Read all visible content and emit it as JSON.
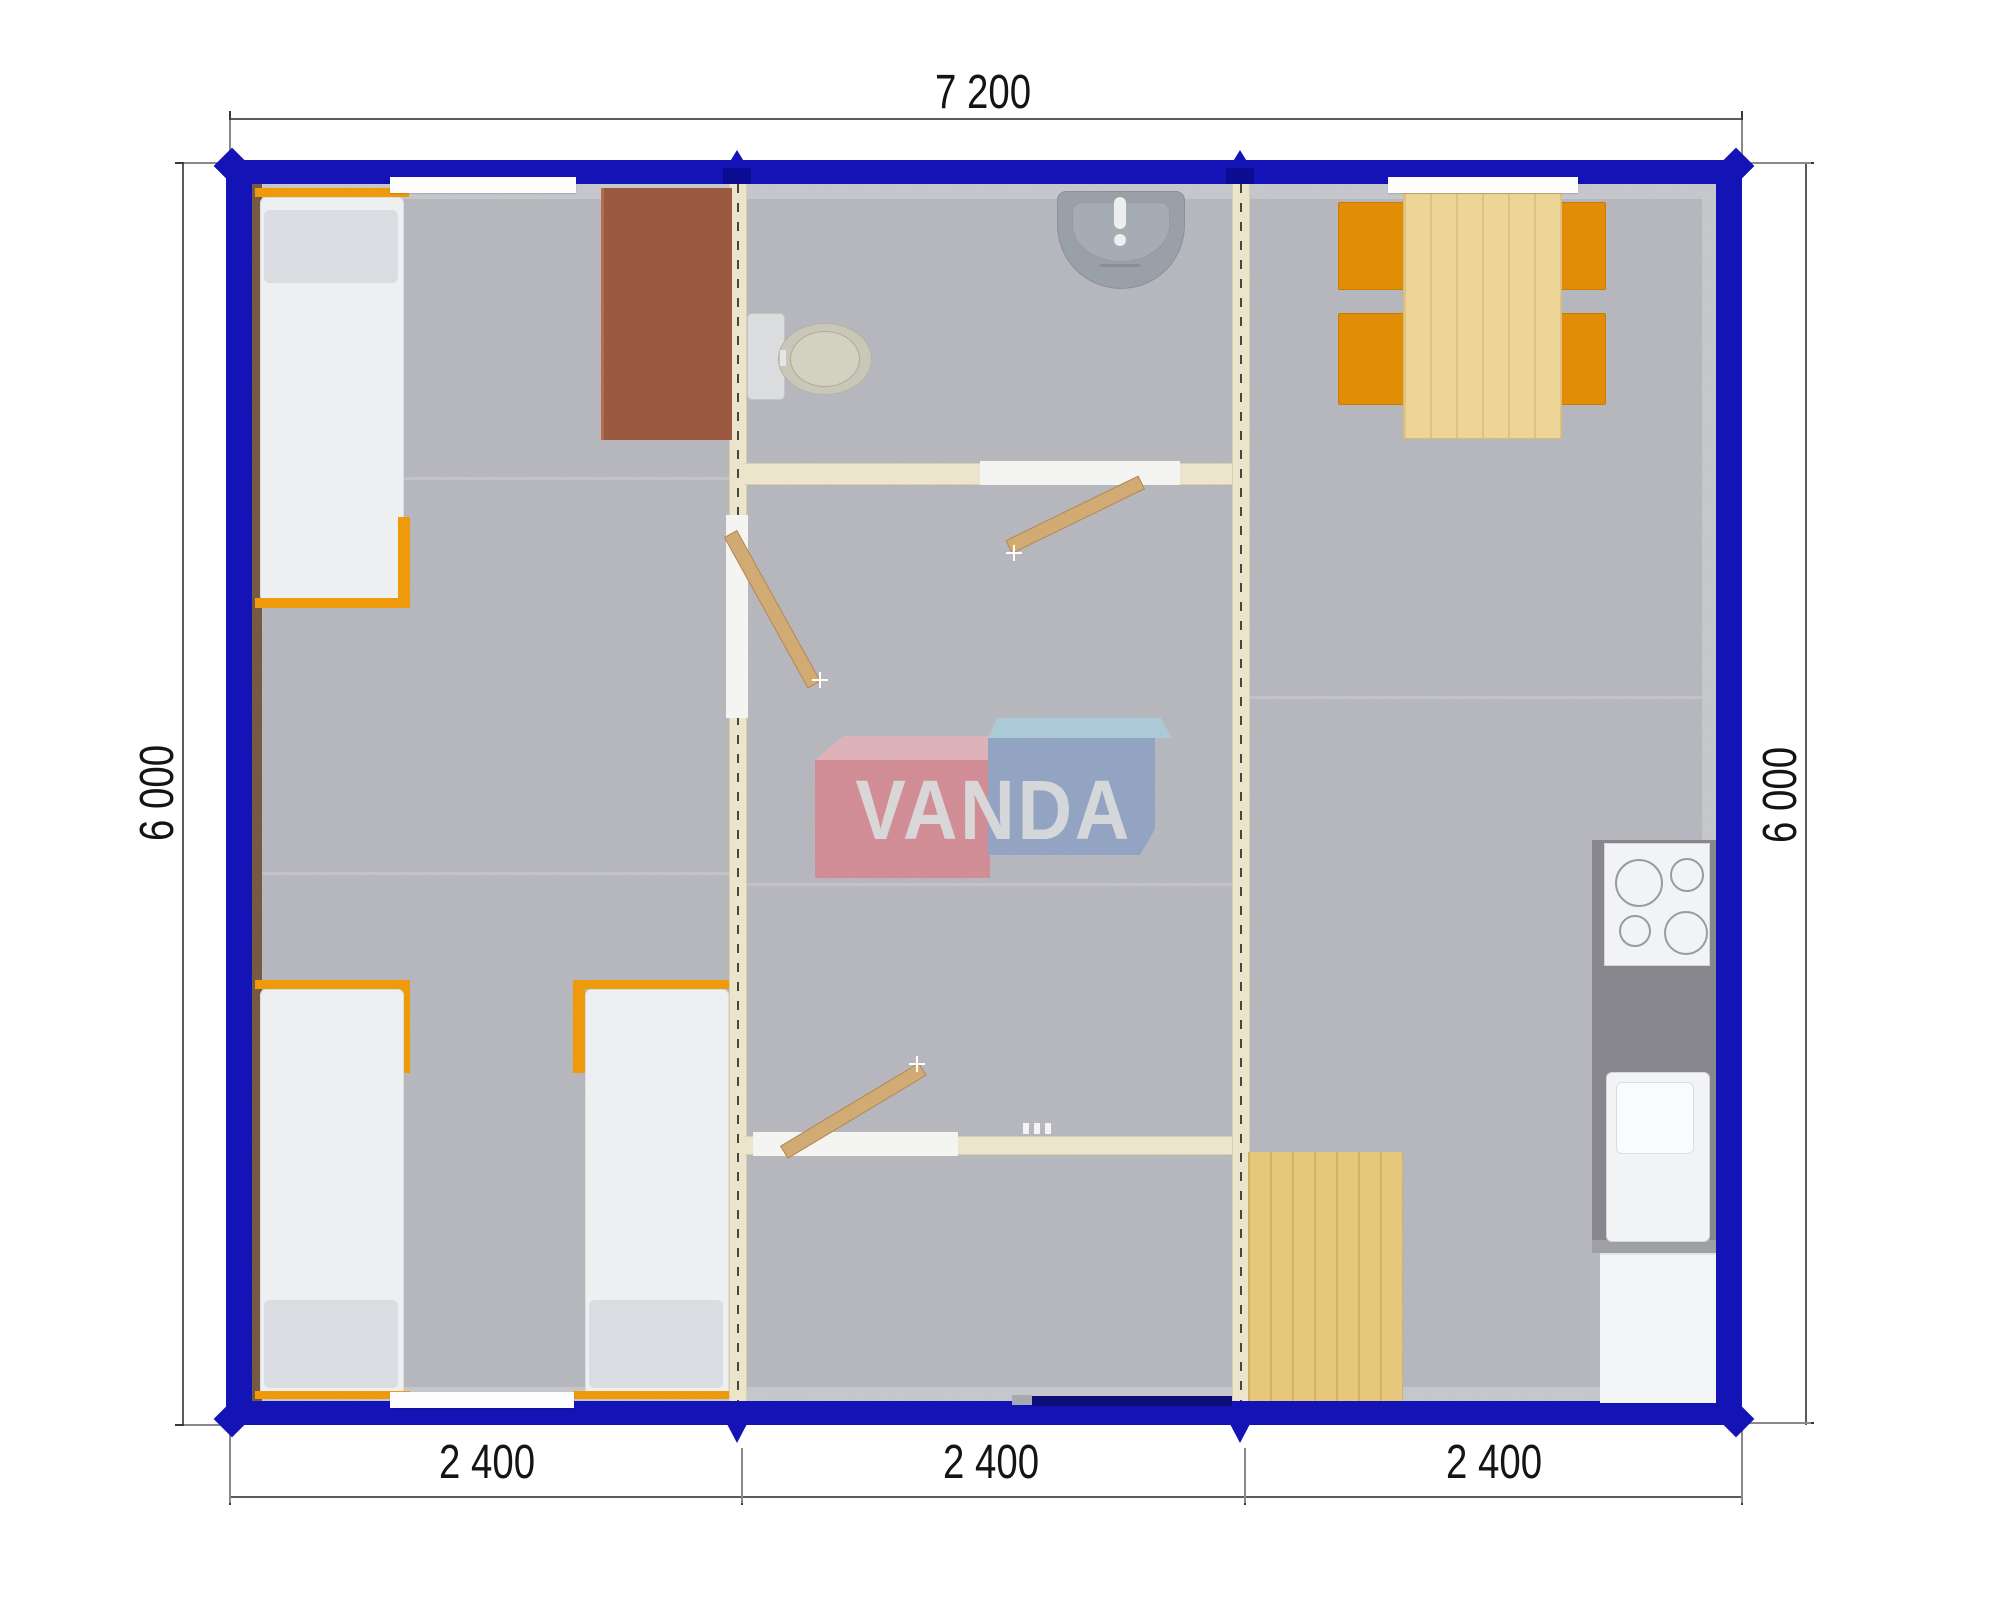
{
  "dimensions": {
    "top_width": "7 200",
    "left_height": "6 000",
    "right_height": "6 000",
    "bottom": [
      "2 400",
      "2 400",
      "2 400"
    ]
  },
  "watermark": {
    "text": "VANDA"
  },
  "colors": {
    "wall_blue": "#1414b6",
    "carpet_gray": "#b6b6be",
    "partition_cream": "#ece4cb",
    "furniture_orange": "#ef9a0a",
    "wood_light": "#ecd596",
    "desk_brown": "#9c5941",
    "counter_gray": "#87878d",
    "watermark_red": "#d8858e",
    "watermark_blue": "#8ba1c4"
  },
  "fixtures": [
    "bed",
    "bed",
    "bed",
    "desk",
    "toilet",
    "wash-basin",
    "dining-table",
    "chair",
    "chair",
    "chair",
    "chair",
    "kitchen-counter",
    "stove",
    "kitchen-sink",
    "cabinet",
    "floor-mat"
  ]
}
